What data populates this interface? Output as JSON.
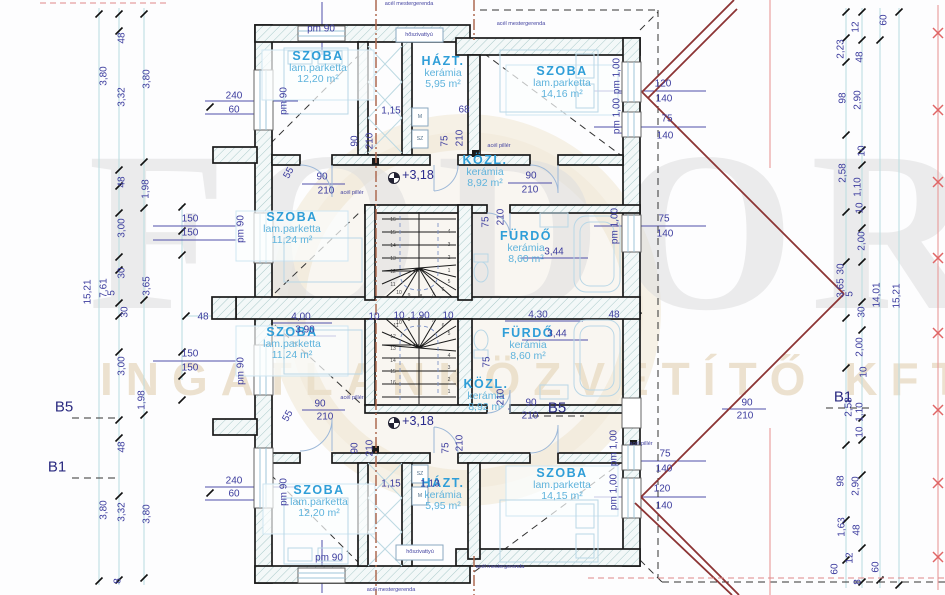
{
  "colors": {
    "wall": "#1a1a1a",
    "room_label": "#2f9ed8",
    "room_sub": "#5fb3dc",
    "dimension_text": "#3c3c9e",
    "roof_dark_red": "#8c3434",
    "roof_light_red": "#e89898",
    "steel_beam_brown": "#ad6a50",
    "wall_hatch": "#a9c9c9",
    "watermark_gray": "#dedede",
    "watermark_beige": "#ebdfca"
  },
  "watermark": {
    "line1": "FODOR",
    "line2": "INGATLANKÖZVETÍTŐ KFT"
  },
  "rooms": [
    {
      "name": "SZOBA",
      "finish": "lam.parketta",
      "area": "12,20 m²",
      "x": 318,
      "y": 68
    },
    {
      "name": "HÁZT.",
      "finish": "kerámia",
      "area": "5,95 m²",
      "x": 443,
      "y": 73
    },
    {
      "name": "SZOBA",
      "finish": "lam.parketta",
      "area": "14,16 m²",
      "x": 562,
      "y": 83
    },
    {
      "name": "KÖZL.",
      "finish": "kerámia",
      "area": "8,92 m²",
      "x": 485,
      "y": 172
    },
    {
      "name": "SZOBA",
      "finish": "lam.parketta",
      "area": "11,24 m²",
      "x": 292,
      "y": 229
    },
    {
      "name": "FÜRDŐ",
      "finish": "kerámia",
      "area": "8,60 m²",
      "x": 526,
      "y": 248
    },
    {
      "name": "SZOBA",
      "finish": "lam.parketta",
      "area": "11,24 m²",
      "x": 292,
      "y": 344
    },
    {
      "name": "FÜRDŐ",
      "finish": "kerámia",
      "area": "8,60 m²",
      "x": 528,
      "y": 345
    },
    {
      "name": "KÖZL.",
      "finish": "kerámia",
      "area": "8,92 m²",
      "x": 486,
      "y": 396
    },
    {
      "name": "HÁZT.",
      "finish": "kerámia",
      "area": "5,95 m²",
      "x": 443,
      "y": 495
    },
    {
      "name": "SZOBA",
      "finish": "lam.parketta",
      "area": "12,20 m²",
      "x": 319,
      "y": 502
    },
    {
      "name": "SZOBA",
      "finish": "lam.parketta",
      "area": "14,15 m²",
      "x": 562,
      "y": 485
    }
  ],
  "levels": [
    {
      "t": "+3,18",
      "x": 418,
      "y": 175
    },
    {
      "t": "+3,18",
      "x": 418,
      "y": 421
    }
  ],
  "sections": [
    {
      "t": "B5",
      "x": 64,
      "y": 407
    },
    {
      "t": "B1",
      "x": 57,
      "y": 467
    },
    {
      "t": "B5",
      "x": 557,
      "y": 408
    },
    {
      "t": "B1",
      "x": 843,
      "y": 397
    }
  ],
  "dims": [
    {
      "t": "48",
      "x": 122,
      "y": 38,
      "r": -90
    },
    {
      "t": "3,80",
      "x": 104,
      "y": 76,
      "r": -90
    },
    {
      "t": "3,32",
      "x": 122,
      "y": 97,
      "r": -90
    },
    {
      "t": "3,80",
      "x": 147,
      "y": 79,
      "r": -90
    },
    {
      "t": "48",
      "x": 122,
      "y": 182,
      "r": -90
    },
    {
      "t": "1,98",
      "x": 146,
      "y": 189,
      "r": -90
    },
    {
      "t": "3,00",
      "x": 122,
      "y": 228,
      "r": -90
    },
    {
      "t": "30",
      "x": 122,
      "y": 273,
      "r": -90
    },
    {
      "t": "15,21",
      "x": 88,
      "y": 292,
      "r": -90
    },
    {
      "t": "7,61",
      "x": 104,
      "y": 288,
      "r": -90
    },
    {
      "t": "5",
      "x": 112,
      "y": 293,
      "r": -90
    },
    {
      "t": "3,65",
      "x": 147,
      "y": 286,
      "r": -90
    },
    {
      "t": "30",
      "x": 125,
      "y": 312,
      "r": -90
    },
    {
      "t": "3,00",
      "x": 122,
      "y": 366,
      "r": -90
    },
    {
      "t": "1,98",
      "x": 142,
      "y": 400,
      "r": -90
    },
    {
      "t": "48",
      "x": 122,
      "y": 447,
      "r": -90
    },
    {
      "t": "3,80",
      "x": 104,
      "y": 510,
      "r": -90
    },
    {
      "t": "3,32",
      "x": 122,
      "y": 512,
      "r": -90
    },
    {
      "t": "3,80",
      "x": 147,
      "y": 514,
      "r": -90
    },
    {
      "t": "8",
      "x": 118,
      "y": 581,
      "r": -90
    },
    {
      "t": "150",
      "x": 190,
      "y": 219
    },
    {
      "t": "150",
      "x": 190,
      "y": 233
    },
    {
      "t": "150",
      "x": 190,
      "y": 354
    },
    {
      "t": "150",
      "x": 190,
      "y": 368
    },
    {
      "t": "48",
      "x": 203,
      "y": 317
    },
    {
      "t": "55",
      "x": 289,
      "y": 173,
      "r": -60
    },
    {
      "t": "55",
      "x": 288,
      "y": 416,
      "r": -60
    },
    {
      "t": "240",
      "x": 234,
      "y": 96
    },
    {
      "t": "60",
      "x": 234,
      "y": 110
    },
    {
      "t": "pm 90",
      "x": 284,
      "y": 101,
      "r": -90
    },
    {
      "t": "pm 90",
      "x": 321,
      "y": 29
    },
    {
      "t": "pm 90",
      "x": 241,
      "y": 229,
      "r": -90
    },
    {
      "t": "pm 90",
      "x": 241,
      "y": 371,
      "r": -90
    },
    {
      "t": "240",
      "x": 234,
      "y": 481
    },
    {
      "t": "60",
      "x": 234,
      "y": 494
    },
    {
      "t": "pm 90",
      "x": 284,
      "y": 492,
      "r": -90
    },
    {
      "t": "pm 90",
      "x": 329,
      "y": 558
    },
    {
      "t": "1,15",
      "x": 391,
      "y": 111
    },
    {
      "t": "68",
      "x": 464,
      "y": 110
    },
    {
      "t": "90",
      "x": 355,
      "y": 141,
      "r": -90
    },
    {
      "t": "210",
      "x": 370,
      "y": 141,
      "r": -90
    },
    {
      "t": "75",
      "x": 445,
      "y": 141,
      "r": -90
    },
    {
      "t": "210",
      "x": 460,
      "y": 138,
      "r": -90
    },
    {
      "t": "90",
      "x": 322,
      "y": 177
    },
    {
      "t": "210",
      "x": 326,
      "y": 191
    },
    {
      "t": "90",
      "x": 531,
      "y": 176
    },
    {
      "t": "210",
      "x": 530,
      "y": 190
    },
    {
      "t": "pm 1,00",
      "x": 617,
      "y": 76,
      "r": -90
    },
    {
      "t": "pm 1,00",
      "x": 617,
      "y": 116,
      "r": -90
    },
    {
      "t": "120",
      "x": 663,
      "y": 84
    },
    {
      "t": "140",
      "x": 664,
      "y": 99
    },
    {
      "t": "75",
      "x": 667,
      "y": 119
    },
    {
      "t": "140",
      "x": 665,
      "y": 136
    },
    {
      "t": "pm 1,00",
      "x": 615,
      "y": 226,
      "r": -90
    },
    {
      "t": "75",
      "x": 664,
      "y": 219
    },
    {
      "t": "140",
      "x": 665,
      "y": 234
    },
    {
      "t": "3,44",
      "x": 554,
      "y": 252
    },
    {
      "t": "75",
      "x": 486,
      "y": 222,
      "r": -90
    },
    {
      "t": "210",
      "x": 501,
      "y": 217,
      "r": -90
    },
    {
      "t": "4,00",
      "x": 301,
      "y": 317
    },
    {
      "t": "3,90",
      "x": 305,
      "y": 330
    },
    {
      "t": "10",
      "x": 374,
      "y": 317
    },
    {
      "t": "10",
      "x": 399,
      "y": 316
    },
    {
      "t": "1,90",
      "x": 420,
      "y": 316
    },
    {
      "t": "10",
      "x": 448,
      "y": 316
    },
    {
      "t": "4,30",
      "x": 538,
      "y": 315
    },
    {
      "t": "48",
      "x": 614,
      "y": 315
    },
    {
      "t": "3,44",
      "x": 557,
      "y": 334
    },
    {
      "t": "75",
      "x": 487,
      "y": 362,
      "r": -90
    },
    {
      "t": "210",
      "x": 501,
      "y": 397,
      "r": -90
    },
    {
      "t": "90",
      "x": 320,
      "y": 404
    },
    {
      "t": "210",
      "x": 325,
      "y": 417
    },
    {
      "t": "90",
      "x": 355,
      "y": 448,
      "r": -90
    },
    {
      "t": "210",
      "x": 370,
      "y": 448,
      "r": -90
    },
    {
      "t": "1,15",
      "x": 391,
      "y": 484
    },
    {
      "t": "1,13",
      "x": 430,
      "y": 484
    },
    {
      "t": "75",
      "x": 446,
      "y": 448,
      "r": -90
    },
    {
      "t": "210",
      "x": 460,
      "y": 443,
      "r": -90
    },
    {
      "t": "90",
      "x": 531,
      "y": 403
    },
    {
      "t": "210",
      "x": 530,
      "y": 416
    },
    {
      "t": "90",
      "x": 747,
      "y": 403
    },
    {
      "t": "210",
      "x": 745,
      "y": 416
    },
    {
      "t": "pm 1,00",
      "x": 614,
      "y": 448,
      "r": -90
    },
    {
      "t": "pm 1,00",
      "x": 614,
      "y": 492,
      "r": -90
    },
    {
      "t": "75",
      "x": 665,
      "y": 454
    },
    {
      "t": "140",
      "x": 664,
      "y": 469
    },
    {
      "t": "120",
      "x": 662,
      "y": 489
    },
    {
      "t": "140",
      "x": 664,
      "y": 506
    },
    {
      "t": "60",
      "x": 884,
      "y": 20,
      "r": -90
    },
    {
      "t": "12",
      "x": 856,
      "y": 27,
      "r": -90
    },
    {
      "t": "2,23",
      "x": 841,
      "y": 49,
      "r": -90
    },
    {
      "t": "48",
      "x": 860,
      "y": 57,
      "r": -90
    },
    {
      "t": "98",
      "x": 843,
      "y": 98,
      "r": -90
    },
    {
      "t": "2,90",
      "x": 858,
      "y": 100,
      "r": -90
    },
    {
      "t": "10",
      "x": 862,
      "y": 151,
      "r": -90
    },
    {
      "t": "2,58",
      "x": 843,
      "y": 173,
      "r": -90
    },
    {
      "t": "1,10",
      "x": 858,
      "y": 187,
      "r": -90
    },
    {
      "t": "10",
      "x": 860,
      "y": 208,
      "r": -90
    },
    {
      "t": "2,00",
      "x": 862,
      "y": 241,
      "r": -90
    },
    {
      "t": "30",
      "x": 841,
      "y": 269,
      "r": -90
    },
    {
      "t": "3,65",
      "x": 841,
      "y": 288,
      "r": -90
    },
    {
      "t": "5",
      "x": 850,
      "y": 294,
      "r": -90
    },
    {
      "t": "30",
      "x": 862,
      "y": 312,
      "r": -90
    },
    {
      "t": "14,01",
      "x": 877,
      "y": 295,
      "r": -90
    },
    {
      "t": "15,21",
      "x": 897,
      "y": 296,
      "r": -90
    },
    {
      "t": "2,00",
      "x": 860,
      "y": 347,
      "r": -90
    },
    {
      "t": "10",
      "x": 864,
      "y": 372,
      "r": -90
    },
    {
      "t": "2,58",
      "x": 849,
      "y": 407,
      "r": -90
    },
    {
      "t": "1,10",
      "x": 860,
      "y": 412,
      "r": -90
    },
    {
      "t": "10",
      "x": 860,
      "y": 432,
      "r": -90
    },
    {
      "t": "98",
      "x": 841,
      "y": 481,
      "r": -90
    },
    {
      "t": "2,90",
      "x": 856,
      "y": 486,
      "r": -90
    },
    {
      "t": "1,63",
      "x": 842,
      "y": 527,
      "r": -90
    },
    {
      "t": "48",
      "x": 857,
      "y": 530,
      "r": -90
    },
    {
      "t": "60",
      "x": 835,
      "y": 569,
      "r": -90
    },
    {
      "t": "12",
      "x": 850,
      "y": 558,
      "r": -90
    },
    {
      "t": "60",
      "x": 876,
      "y": 567,
      "r": -90
    },
    {
      "t": "8",
      "x": 858,
      "y": 582,
      "r": -90
    }
  ],
  "notes": [
    {
      "t": "acél mestergerenda",
      "x": 409,
      "y": 4
    },
    {
      "t": "acél mestergerenda",
      "x": 521,
      "y": 24
    },
    {
      "t": "acél mestergerenda",
      "x": 500,
      "y": 567
    },
    {
      "t": "acél mestergerenda",
      "x": 391,
      "y": 590
    },
    {
      "t": "acél pillér",
      "x": 352,
      "y": 193
    },
    {
      "t": "acél pillér",
      "x": 499,
      "y": 146
    },
    {
      "t": "acél pillér",
      "x": 352,
      "y": 398
    },
    {
      "t": "acél pillér",
      "x": 641,
      "y": 444
    },
    {
      "t": "hőszivattyú",
      "x": 419,
      "y": 35
    },
    {
      "t": "hőszivattyú",
      "x": 420,
      "y": 552
    }
  ],
  "appliances": [
    {
      "t": "M",
      "x": 420,
      "y": 117
    },
    {
      "t": "SZ",
      "x": 420,
      "y": 139
    },
    {
      "t": "SZ",
      "x": 420,
      "y": 474
    },
    {
      "t": "M",
      "x": 420,
      "y": 496
    }
  ],
  "stair_steps": {
    "top": [
      {
        "t": "16",
        "x": 393,
        "y": 220
      },
      {
        "t": "15",
        "x": 393,
        "y": 233
      },
      {
        "t": "14",
        "x": 393,
        "y": 246
      },
      {
        "t": "13",
        "x": 393,
        "y": 259
      },
      {
        "t": "12",
        "x": 393,
        "y": 272
      },
      {
        "t": "11",
        "x": 393,
        "y": 285
      },
      {
        "t": "10",
        "x": 399,
        "y": 293
      },
      {
        "t": "9",
        "x": 409,
        "y": 296
      },
      {
        "t": "8",
        "x": 421,
        "y": 297
      },
      {
        "t": "7",
        "x": 433,
        "y": 295
      },
      {
        "t": "6",
        "x": 443,
        "y": 290
      },
      {
        "t": "5",
        "x": 449,
        "y": 282
      },
      {
        "t": "4",
        "x": 449,
        "y": 232
      },
      {
        "t": "3",
        "x": 449,
        "y": 245
      },
      {
        "t": "2",
        "x": 449,
        "y": 258
      },
      {
        "t": "1",
        "x": 449,
        "y": 271
      }
    ],
    "bottom": [
      {
        "t": "11",
        "x": 396,
        "y": 326
      },
      {
        "t": "12",
        "x": 393,
        "y": 337
      },
      {
        "t": "13",
        "x": 393,
        "y": 349
      },
      {
        "t": "14",
        "x": 393,
        "y": 361
      },
      {
        "t": "15",
        "x": 393,
        "y": 372
      },
      {
        "t": "16",
        "x": 393,
        "y": 383
      },
      {
        "t": "10",
        "x": 399,
        "y": 323
      },
      {
        "t": "9",
        "x": 409,
        "y": 320
      },
      {
        "t": "8",
        "x": 421,
        "y": 319
      },
      {
        "t": "7",
        "x": 433,
        "y": 321
      },
      {
        "t": "6",
        "x": 443,
        "y": 326
      },
      {
        "t": "5",
        "x": 449,
        "y": 334
      },
      {
        "t": "4",
        "x": 449,
        "y": 356
      },
      {
        "t": "3",
        "x": 449,
        "y": 368
      },
      {
        "t": "2",
        "x": 449,
        "y": 380
      },
      {
        "t": "1",
        "x": 449,
        "y": 392
      }
    ]
  }
}
